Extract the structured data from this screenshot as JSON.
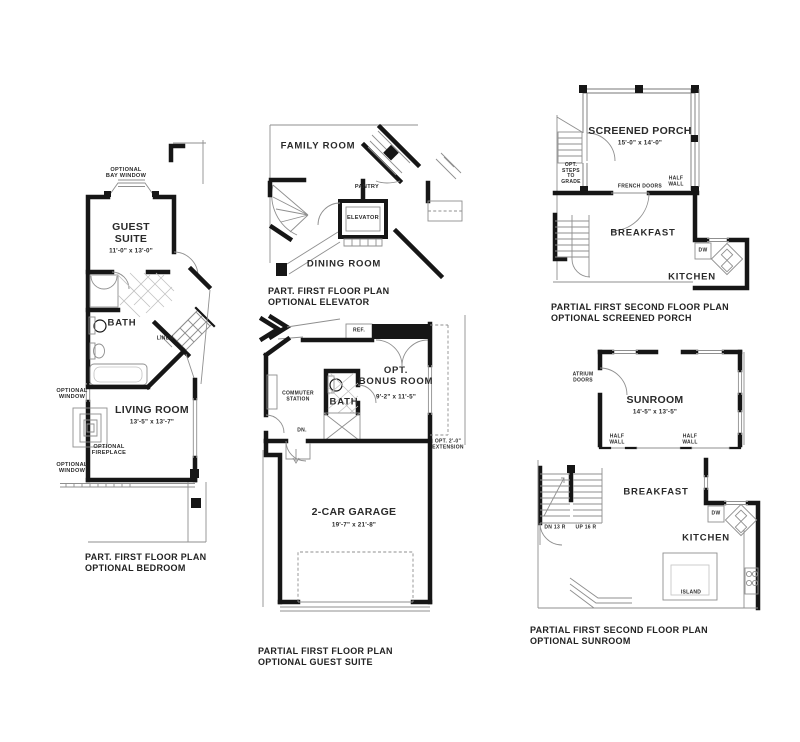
{
  "page": {
    "background": "#ffffff",
    "wall_color": "#161616",
    "line_color": "#8f8f8f"
  },
  "plans": {
    "optional_bedroom": {
      "caption": "PART. FIRST FLOOR PLAN\nOPTIONAL BEDROOM",
      "labels": {
        "bay_window": "OPTIONAL\nBAY WINDOW",
        "room1_name": "GUEST\nSUITE",
        "room1_dim": "11'-0\" x 13'-0\"",
        "bath": "BATH",
        "linen": "LINEN",
        "window_upper": "OPTIONAL\nWINDOW",
        "room2_name": "LIVING ROOM",
        "room2_dim": "13'-5\" x 13'-7\"",
        "fireplace": "OPTIONAL\nFIREPLACE",
        "window_lower": "OPTIONAL\nWINDOW"
      }
    },
    "optional_elevator": {
      "caption": "PART. FIRST FLOOR PLAN\nOPTIONAL ELEVATOR",
      "labels": {
        "family_room": "FAMILY ROOM",
        "pantry": "PANTRY",
        "elevator": "ELEVATOR",
        "dining_room": "DINING ROOM"
      }
    },
    "optional_screened_porch": {
      "caption": "PARTIAL FIRST SECOND FLOOR PLAN\nOPTIONAL SCREENED PORCH",
      "labels": {
        "porch_name": "SCREENED PORCH",
        "porch_dim": "15'-0\" x 14'-0\"",
        "steps": "OPT.\nSTEPS\nTO\nGRADE",
        "french_doors": "FRENCH DOORS",
        "half_wall": "HALF\nWALL",
        "breakfast": "BREAKFAST",
        "dw": "DW",
        "kitchen": "KITCHEN"
      }
    },
    "optional_guest_suite": {
      "caption": "PARTIAL FIRST FLOOR PLAN\nOPTIONAL GUEST SUITE",
      "labels": {
        "ref": "REF.",
        "bonus_name": "OPT.\nBONUS ROOM",
        "bonus_dim": "9'-2\" x 11'-5\"",
        "commuter": "COMMUTER\nSTATION",
        "bath": "BATH",
        "dn": "DN.",
        "extension": "OPT. 2'-0\"\nEXTENSION",
        "garage_name": "2-CAR GARAGE",
        "garage_dim": "19'-7\" x 21'-8\""
      }
    },
    "optional_sunroom": {
      "caption": "PARTIAL FIRST SECOND FLOOR PLAN\nOPTIONAL SUNROOM",
      "labels": {
        "atrium_doors": "ATRIUM\nDOORS",
        "sunroom_name": "SUNROOM",
        "sunroom_dim": "14'-5\" x 13'-5\"",
        "half_wall_left": "HALF\nWALL",
        "half_wall_right": "HALF\nWALL",
        "breakfast": "BREAKFAST",
        "dn": "DN 13 R",
        "up": "UP 16 R",
        "dw": "DW",
        "kitchen": "KITCHEN",
        "island": "ISLAND"
      }
    }
  }
}
